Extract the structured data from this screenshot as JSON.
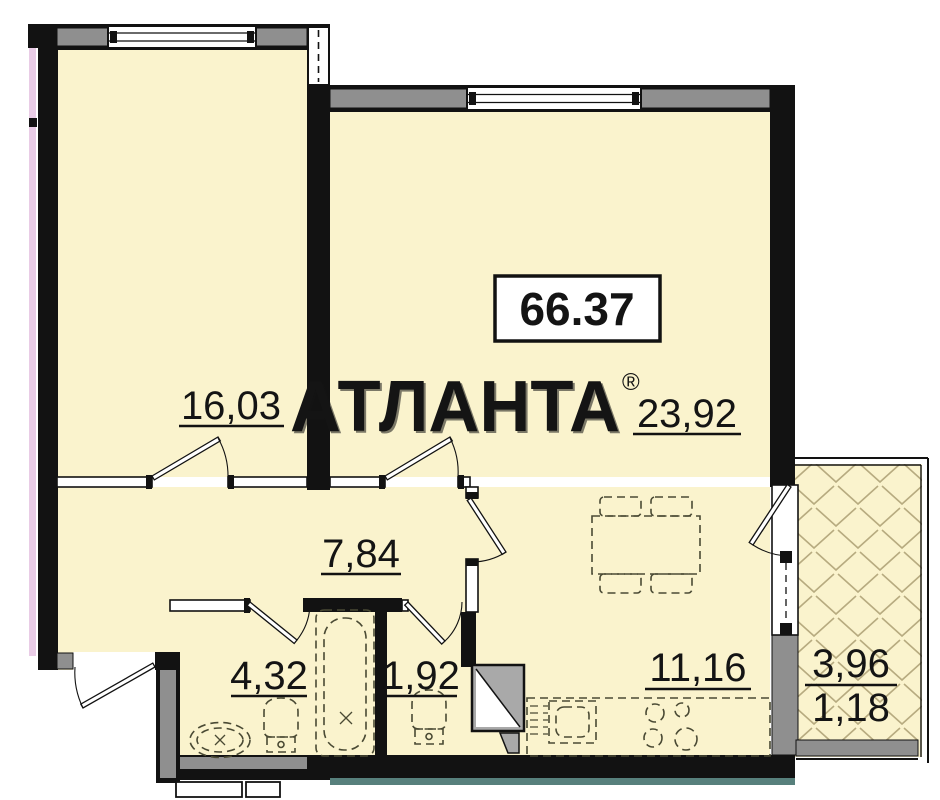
{
  "plan": {
    "watermark": {
      "text": "АТЛАНТА",
      "registered_mark": "®"
    },
    "total_area_box": {
      "value": "66.37"
    },
    "rooms": {
      "living_room": {
        "area": "16,03"
      },
      "bedroom": {
        "area": "23,92"
      },
      "hallway": {
        "area": "7,84"
      },
      "bathroom": {
        "area": "4,32"
      },
      "wc": {
        "area": "1,92"
      },
      "kitchen": {
        "area": "11,16"
      },
      "balcony": {
        "area_total": "3,96",
        "area_reduced": "1,18"
      }
    },
    "colors": {
      "floor_fill": "#faf3cd",
      "wall": "#121212",
      "window_sill_gray": "#8f8f8f",
      "watermark_gray": "#cccccc",
      "accent_pink": "#e9cce6",
      "accent_teal": "#57807c",
      "hatch_line": "#b7ab80"
    }
  }
}
